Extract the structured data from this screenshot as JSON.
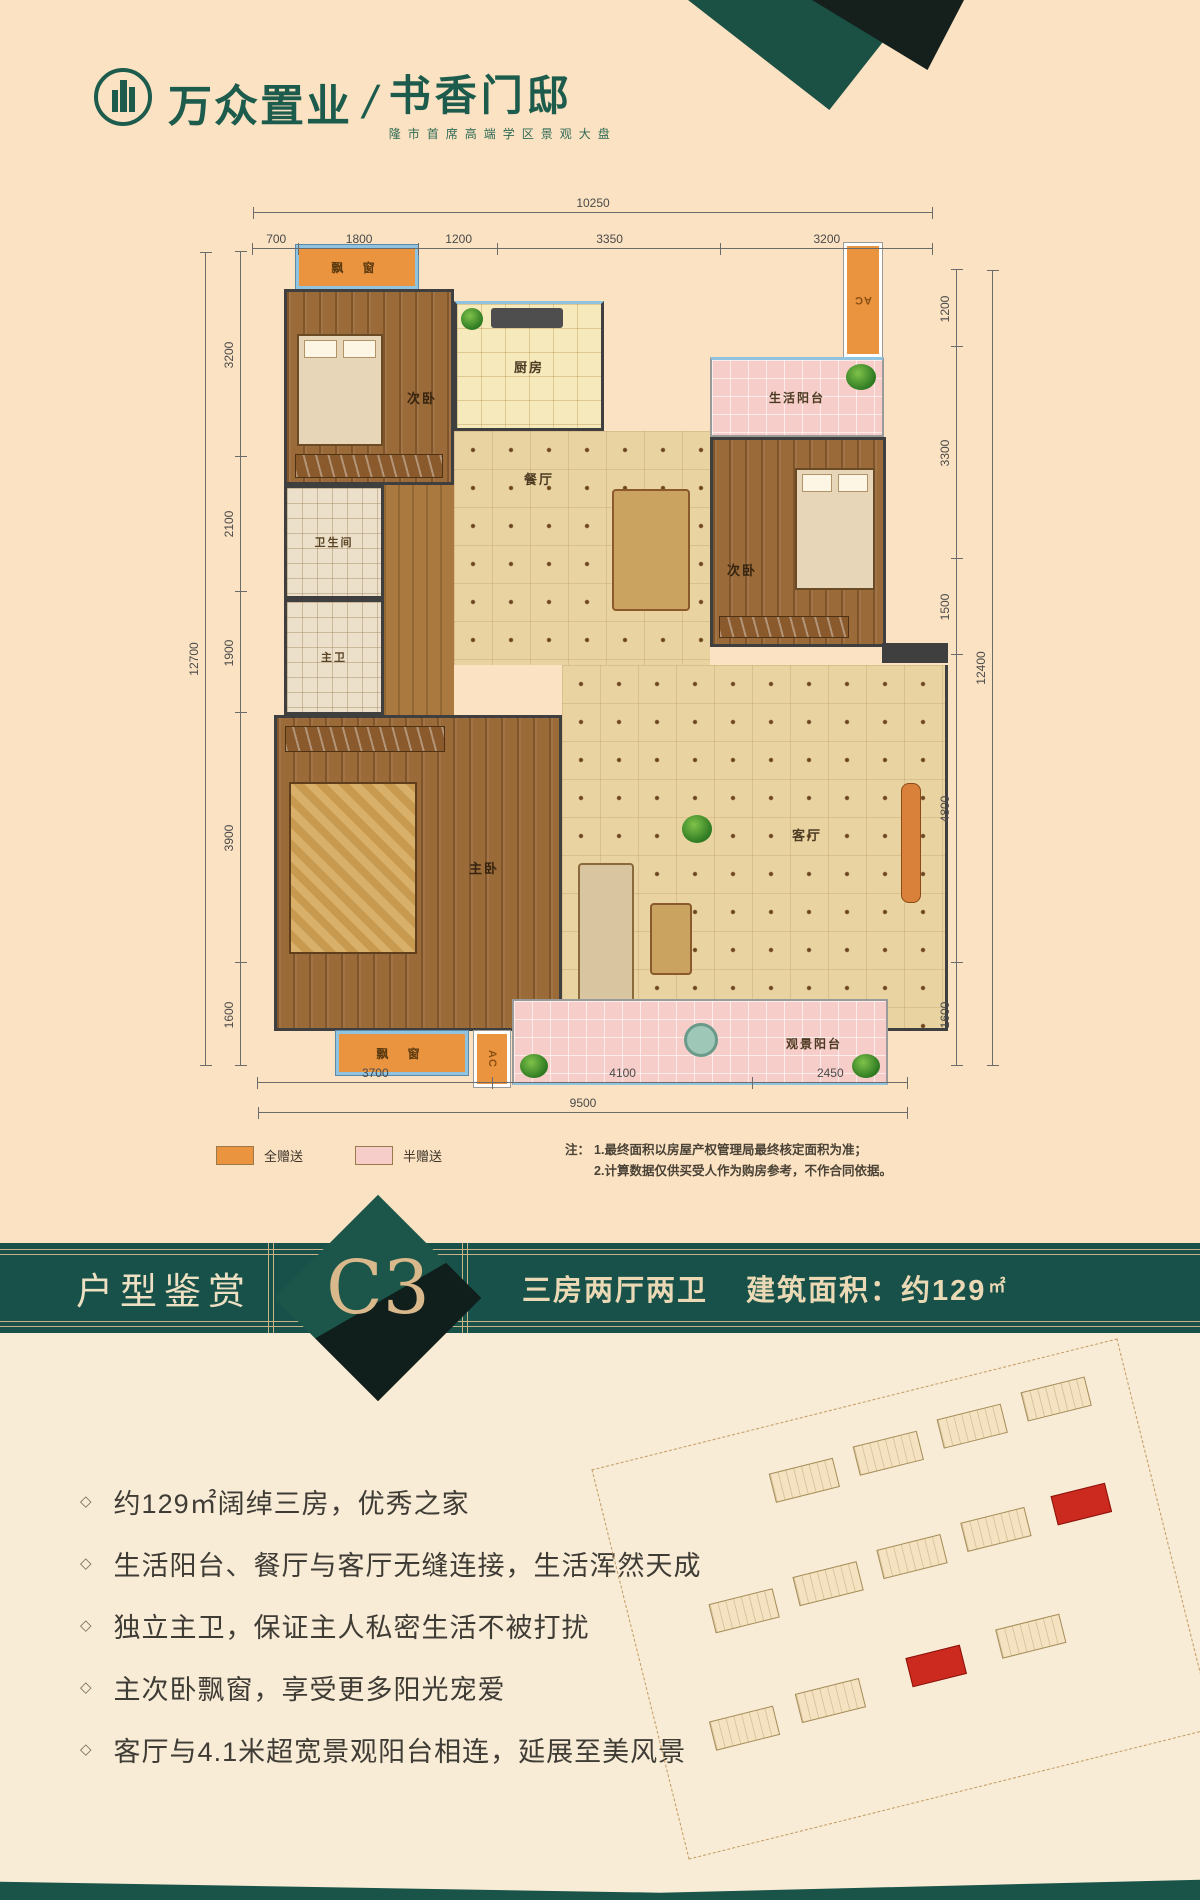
{
  "brand": {
    "logo_text": "万众置业",
    "separator": "/",
    "project_name": "书香门邸",
    "tagline": "隆市首席高端学区景观大盘"
  },
  "plan": {
    "rooms": {
      "bay_top": "飘 窗",
      "bedroom_tl": "次卧",
      "kitchen": "厨房",
      "ac_top": "AC",
      "balcony_top": "生活阳台",
      "dining": "餐厅",
      "bedroom_right": "次卧",
      "bath": "卫生间",
      "master_bath": "主卫",
      "master_bedroom": "主卧",
      "living": "客厅",
      "bay_bottom": "飘 窗",
      "ac_bottom": "AC",
      "balcony_bottom": "观景阳台"
    },
    "dimensions": {
      "top": {
        "total": "10250",
        "segments": [
          "700",
          "1800",
          "1200",
          "3350",
          "3200"
        ]
      },
      "bottom": {
        "total": "9500",
        "segments": [
          "3700",
          "4100",
          "2450"
        ]
      },
      "left": {
        "total": "12700",
        "segments": [
          "3200",
          "2100",
          "1900",
          "3900",
          "1600"
        ]
      },
      "right": {
        "total": "12400",
        "segments": [
          "1200",
          "3300",
          "1500",
          "4800",
          "1600"
        ]
      }
    }
  },
  "legend": {
    "items": [
      {
        "label": "全赠送",
        "color": "#ea9440"
      },
      {
        "label": "半赠送",
        "color": "#f6cdc8"
      }
    ]
  },
  "note": {
    "prefix": "注：",
    "lines": [
      "1.最终面积以房屋产权管理局最终核定面积为准；",
      "2.计算数据仅供买受人作为购房参考，不作合同依据。"
    ]
  },
  "banner": {
    "section_title": "户型鉴赏",
    "unit_code": "C3",
    "layout": "三房两厅两卫",
    "area_label": "建筑面积：约129",
    "area_unit": "㎡"
  },
  "feature_marker": "◇",
  "features": [
    "约129㎡阔绰三房，优秀之家",
    "生活阳台、餐厅与客厅无缝连接，生活浑然天成",
    "独立主卫，保证主人私密生活不被打扰",
    "主次卧飘窗，享受更多阳光宠爱",
    "客厅与4.1米超宽景观阳台相连，延展至美风景"
  ],
  "site_plan": {
    "buildings": [
      {
        "x": 170,
        "y": 46,
        "w": 66,
        "h": 30,
        "highlight": false
      },
      {
        "x": 258,
        "y": 40,
        "w": 66,
        "h": 30,
        "highlight": false
      },
      {
        "x": 346,
        "y": 34,
        "w": 66,
        "h": 30,
        "highlight": false
      },
      {
        "x": 434,
        "y": 28,
        "w": 66,
        "h": 30,
        "highlight": false
      },
      {
        "x": 80,
        "y": 158,
        "w": 66,
        "h": 30,
        "highlight": false
      },
      {
        "x": 168,
        "y": 152,
        "w": 66,
        "h": 30,
        "highlight": false
      },
      {
        "x": 256,
        "y": 146,
        "w": 66,
        "h": 30,
        "highlight": false
      },
      {
        "x": 344,
        "y": 140,
        "w": 66,
        "h": 30,
        "highlight": false
      },
      {
        "x": 438,
        "y": 136,
        "w": 56,
        "h": 30,
        "highlight": true
      },
      {
        "x": 52,
        "y": 272,
        "w": 66,
        "h": 30,
        "highlight": false
      },
      {
        "x": 142,
        "y": 266,
        "w": 66,
        "h": 30,
        "highlight": false
      },
      {
        "x": 258,
        "y": 258,
        "w": 56,
        "h": 30,
        "highlight": true
      },
      {
        "x": 352,
        "y": 252,
        "w": 66,
        "h": 30,
        "highlight": false
      }
    ]
  },
  "colors": {
    "banner_green": "#175149",
    "gold": "#c9b286",
    "cream_text": "#eee0c2",
    "unit_code_tan": "#d9b98b",
    "full_gift_orange": "#ea9440",
    "half_gift_pink": "#f6cdc8",
    "background_top": "#fbe2c2",
    "background_bottom": "#f8ecd6",
    "highlight_red": "#cc2a1e"
  }
}
